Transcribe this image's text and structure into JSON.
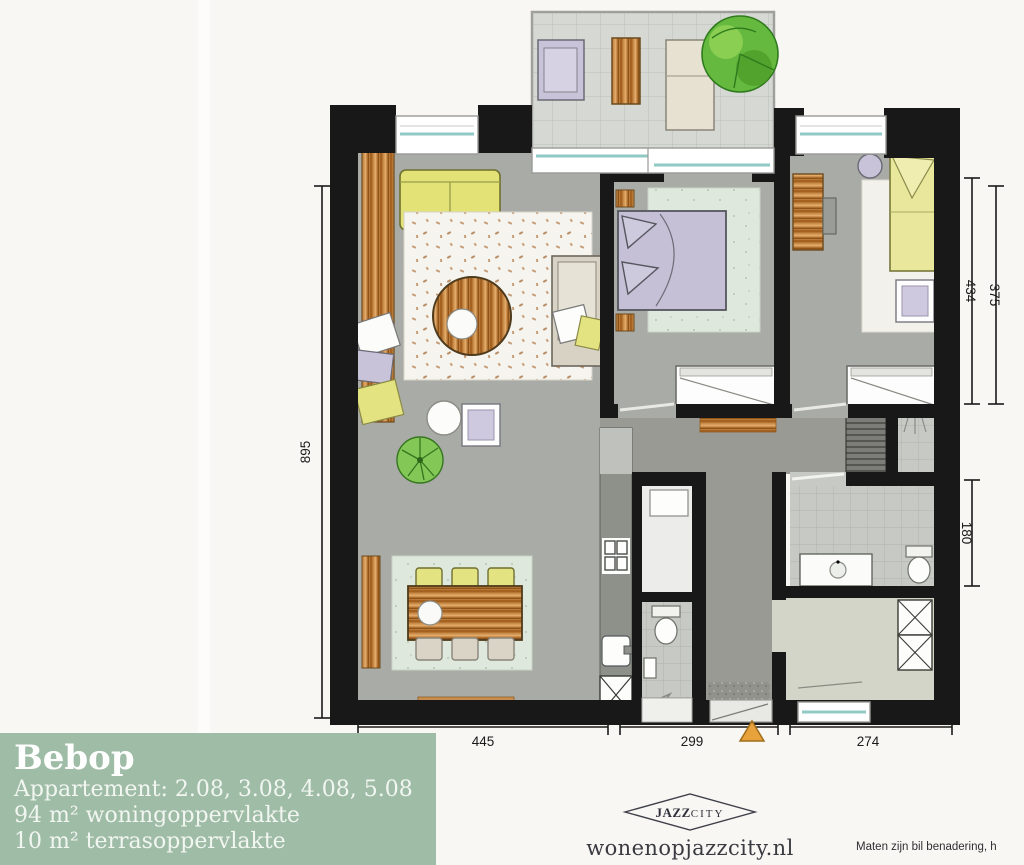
{
  "info_box": {
    "title": "Bebop",
    "apartment_line": "Appartement: 2.08, 3.08, 4.08, 5.08",
    "area_line": "94 m² woningoppervlakte",
    "terrace_line": "10 m² terrasoppervlakte",
    "bg_color": "#9fbca7"
  },
  "plan": {
    "dimensions": {
      "left_height": "895",
      "right_top_inner": "434",
      "right_top_outer": "375",
      "right_bottom": "180",
      "bottom_left": "445",
      "bottom_center": "299",
      "bottom_right": "274"
    },
    "colors": {
      "wall": "#181818",
      "glass": "#8fcac4",
      "entrance_marker": "#e8a23c"
    }
  },
  "footer": {
    "logo_jazz": "JAZZ",
    "logo_city": "CITY",
    "website": "wonenopjazzcity.nl",
    "disclaimer": "Maten zijn bil benadering, h"
  }
}
